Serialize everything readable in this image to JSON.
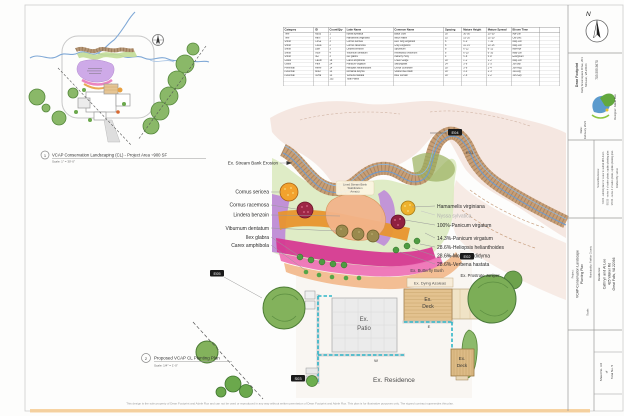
{
  "sheet": {
    "footer": "This design is the sole property of Dean Footprint and Adele Rux and can not be used or reproduced in any way without written permission of Dean Footprint and Adele Rux. This plan is for illustrative purposes only. The signed contract supersedes this plan."
  },
  "colors": {
    "stream_blue": "#6b9bd2",
    "bank_tan": "#c49a70",
    "bed_green": "#dceac0",
    "bed_purple": "#bf8cd8",
    "bed_orange": "#e8952e",
    "bed_magenta": "#d63a92",
    "bed_salmon": "#f2bb8e",
    "tree_green": "#83b25c",
    "wall_teal": "#2fb6c8"
  },
  "cap1": {
    "num": "1",
    "title": "VCAP Conservation Landscaping (CL) - Project Area ~900 SF",
    "scale": "Scale: 1\" = 30'-0\""
  },
  "cap2": {
    "num": "2",
    "title": "Proposed VCAP CL Planting Plan",
    "scale": "Scale: 1/4\" = 1'-0\""
  },
  "schedule": {
    "columns": [
      "Category",
      "ID",
      "Count/Qty",
      "Latin Name",
      "Common Name",
      "Spacing",
      "Mature Height",
      "Mature Spread",
      "Bloom Time",
      ""
    ],
    "rows": [
      [
        "Tree",
        "NySy",
        "1",
        "Nyssa sylvatica",
        "Black Gum",
        "30'",
        "30'-50'",
        "20'-30'",
        "Apr-Jun",
        ""
      ],
      [
        "Tree",
        "HaVi",
        "1",
        "Hamamelis virginiana",
        "Witch Hazel",
        "15'",
        "15'-20'",
        "15'-20'",
        "Oct-Dec",
        ""
      ],
      [
        "Shrub",
        "CoSe",
        "3",
        "Cornus sericea",
        "Red Twig Dogwood",
        "6'",
        "6'-9'",
        "7'-10'",
        "May-Jun",
        ""
      ],
      [
        "Shrub",
        "CoRa",
        "2",
        "Cornus racemosa",
        "Gray Dogwood",
        "8'",
        "10'-15'",
        "10'-15'",
        "May-Jun",
        ""
      ],
      [
        "Shrub",
        "LiBe",
        "3",
        "Lindera benzoin",
        "Spicebush",
        "8'",
        "6'-12'",
        "6'-12'",
        "Mar-Apr",
        ""
      ],
      [
        "Shrub",
        "ViDe",
        "4",
        "Viburnum dentatum",
        "Arrowwood Viburnum",
        "6'",
        "6'-10'",
        "6'-10'",
        "May-Jun",
        ""
      ],
      [
        "Shrub",
        "IlGl",
        "3",
        "Ilex glabra",
        "Inkberry Holly",
        "4'",
        "5'-8'",
        "5'-8'",
        "Evergreen",
        ""
      ],
      [
        "Grass",
        "CaAm",
        "18",
        "Carex amphibola",
        "Creek Sedge",
        "18\"",
        "1'-2'",
        "1'-2'",
        "May-Jun",
        ""
      ],
      [
        "Grass",
        "PaVi",
        "24",
        "Panicum virgatum",
        "Switchgrass",
        "24\"",
        "3'-6'",
        "2'-3'",
        "Jul-Sep",
        ""
      ],
      [
        "Perennial",
        "HeHe",
        "14",
        "Heliopsis helianthoides",
        "Oxeye Sunflower",
        "18\"",
        "3'-6'",
        "2'-4'",
        "Jun-Aug",
        ""
      ],
      [
        "Perennial",
        "MoDi",
        "14",
        "Monarda didyma",
        "Scarlet Bee Balm",
        "18\"",
        "3'-4'",
        "2'-3'",
        "Jul-Aug",
        ""
      ],
      [
        "Perennial",
        "VeHa",
        "14",
        "Verbena hastata",
        "Blue Vervain",
        "18\"",
        "2'-6'",
        "1'-2'",
        "Jun-Sep",
        ""
      ],
      [
        "",
        "",
        "102",
        "Total Plants",
        "",
        "",
        "",
        "",
        "",
        ""
      ],
      [
        "",
        "",
        "",
        "",
        "",
        "",
        "",
        "",
        "",
        ""
      ],
      [
        "",
        "",
        "",
        "",
        "",
        "",
        "",
        "",
        "",
        ""
      ]
    ]
  },
  "main": {
    "stream_note": [
      "Lined Stream Bank",
      "Stabilization",
      "Area(s)"
    ],
    "labels_left": [
      "Ex. Stream Bank Erosion",
      "Cornus sericea",
      "Cornus racemosa",
      "Lindera benzoin",
      "Viburnum dentatum",
      "Ilex glabra",
      "Carex amphibola"
    ],
    "labels_right": [
      "Hamamelis virginiana",
      "Nyssa sylvatica",
      "100%-Panicum virgatum",
      "14.3%-Panicum virgatum",
      "28.6%-Heliopsis helianthoides",
      "28.6%-Monarda didyma",
      "28.6%-Verbena hastata"
    ],
    "tags": {
      "e04": "E04",
      "e03": "E03",
      "e02": "E02",
      "e05": "E05",
      "s03": "S03"
    },
    "site": {
      "butterfly": "Ex. Butterfly Bush",
      "juniper": "Ex. Prostrate Juniper",
      "azaleas": "Ex. Dying Azaleas",
      "deck_upper": [
        "Ex.",
        "Deck"
      ],
      "deck_lower": [
        "Ex.",
        "Deck"
      ],
      "patio": [
        "Ex.",
        "Patio"
      ],
      "residence": "Ex. Residence",
      "wall_w": "W",
      "wall_e": "E"
    }
  },
  "tb": {
    "north": "N",
    "company": {
      "name": "Dean Footprint",
      "address1": "Kelly Greenspace Drive, 201",
      "address2": "McLean, VA 22101",
      "phone": "703.555.5670",
      "designer": "Designer:   Adele Rux",
      "date_label": "Date:",
      "date": "February 2021"
    },
    "revisions": {
      "heading": "Notes/Revisions:",
      "item1": "7/2/20 - submit plans for owner to submit RPA Form",
      "item2": "8/5/20 - revise # of native plants, update planting plan",
      "item3": "9/5/20 - revise # of native plants, update planting plan",
      "drafted": "Drafted By:  will.st"
    },
    "client": {
      "heading": "Residence:",
      "name": "Cathryn and Al Lee",
      "address1": "425 Walker Rd",
      "address2": "Great Falls, VA 22066"
    },
    "project": {
      "heading": "Project:",
      "name1": "VCAP-Conservation Landscape",
      "name2": "Planting Plan",
      "scale_label": "Scale:",
      "municipality": "Municipality:   Fairfax County"
    },
    "sheetno": {
      "line1": "Sheet No.   3.0",
      "line2": "of",
      "line3": "Total No.   5"
    }
  }
}
